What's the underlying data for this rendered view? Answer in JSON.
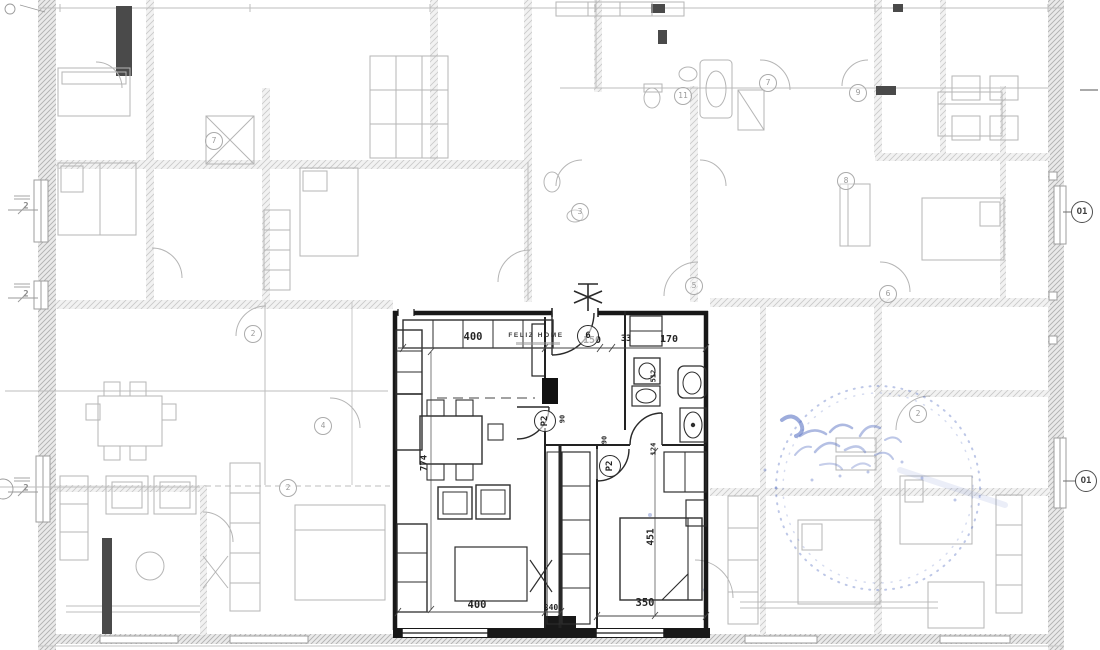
{
  "colors": {
    "ink": "#1a1a1a",
    "faint_ink": "#b6b6b6",
    "stamp_blue": "#5b74c4",
    "paper": "#ffffff"
  },
  "stamp": {
    "t": "FELIZ HOME",
    "x": 536,
    "y": 336,
    "s": 6.5,
    "ls": 1.6,
    "w": 700
  },
  "apartment": {
    "dimension_labels": [
      {
        "t": "400",
        "x": 473,
        "y": 337,
        "s": 10.5
      },
      {
        "t": "150",
        "x": 592,
        "y": 341,
        "s": 10
      },
      {
        "t": "33",
        "x": 626,
        "y": 339,
        "s": 8.5
      },
      {
        "t": "170",
        "x": 669,
        "y": 340,
        "s": 10
      },
      {
        "t": "774",
        "x": 425,
        "y": 463,
        "s": 9,
        "r": -90
      },
      {
        "t": "512",
        "x": 654,
        "y": 376,
        "s": 7,
        "r": -90
      },
      {
        "t": "124",
        "x": 654,
        "y": 449,
        "s": 7,
        "r": -90
      },
      {
        "t": "90",
        "x": 563,
        "y": 419,
        "s": 7,
        "r": -90
      },
      {
        "t": "90",
        "x": 605,
        "y": 440,
        "s": 7,
        "r": -90
      },
      {
        "t": "451",
        "x": 651,
        "y": 537,
        "s": 9.5,
        "r": -90
      },
      {
        "t": "400",
        "x": 477,
        "y": 605,
        "s": 10.5
      },
      {
        "t": "240",
        "x": 551,
        "y": 608,
        "s": 8
      },
      {
        "t": "350",
        "x": 645,
        "y": 603,
        "s": 10.5
      }
    ],
    "door_tags": [
      {
        "t": "P2",
        "x": 545,
        "y": 421,
        "rad": 11,
        "r": -90
      },
      {
        "t": "P2",
        "x": 610,
        "y": 466,
        "rad": 11,
        "r": -90
      }
    ],
    "room_tags": [
      {
        "t": "6",
        "x": 588,
        "y": 336,
        "rad": 11
      }
    ]
  },
  "window_markers": [
    {
      "t": "O1",
      "x": 1082,
      "y": 212,
      "rad": 11
    },
    {
      "t": "O1",
      "x": 1086,
      "y": 481,
      "rad": 11
    }
  ],
  "background_tags": [
    {
      "t": "7",
      "x": 214,
      "y": 141
    },
    {
      "t": "2",
      "x": 253,
      "y": 334
    },
    {
      "t": "2",
      "x": 288,
      "y": 488
    },
    {
      "t": "4",
      "x": 323,
      "y": 426
    },
    {
      "t": "3",
      "x": 580,
      "y": 212
    },
    {
      "t": "11",
      "x": 683,
      "y": 96
    },
    {
      "t": "7",
      "x": 768,
      "y": 83
    },
    {
      "t": "9",
      "x": 858,
      "y": 93
    },
    {
      "t": "8",
      "x": 846,
      "y": 181
    },
    {
      "t": "5",
      "x": 694,
      "y": 286
    },
    {
      "t": "6",
      "x": 888,
      "y": 294
    },
    {
      "t": "2",
      "x": 918,
      "y": 414
    }
  ],
  "wall_markers": [
    {
      "t": "2",
      "x": 26,
      "y": 207
    },
    {
      "t": "2",
      "x": 26,
      "y": 295
    },
    {
      "t": "2",
      "x": 26,
      "y": 489
    }
  ]
}
